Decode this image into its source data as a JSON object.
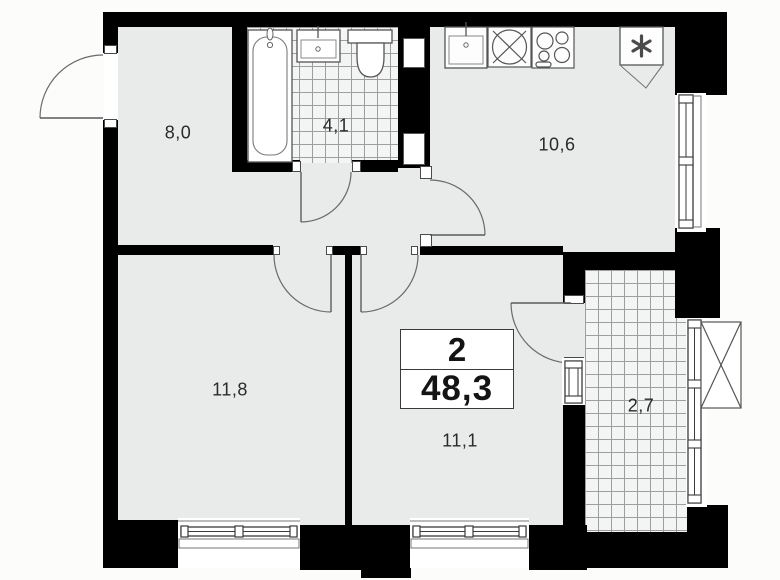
{
  "plan": {
    "title": "2-room apartment floor plan",
    "summary": {
      "rooms_count": "2",
      "total_area": "48,3"
    },
    "rooms": [
      {
        "name": "hallway",
        "area": "8,0"
      },
      {
        "name": "bathroom",
        "area": "4,1"
      },
      {
        "name": "kitchen",
        "area": "10,6"
      },
      {
        "name": "living-room",
        "area": "11,8"
      },
      {
        "name": "bedroom",
        "area": "11,1"
      },
      {
        "name": "balcony",
        "area": "2,7"
      }
    ],
    "icons": [
      "bathtub-icon",
      "bath-sink-icon",
      "toilet-icon",
      "kitchen-sink-icon",
      "washing-machine-icon",
      "stove-icon",
      "fridge-icon",
      "ac-unit-icon",
      "door-arc-icon",
      "window-icon"
    ],
    "colors": {
      "wall": "#000000",
      "floor": "#e9ebeb",
      "tile_floor": "#f3f4f4",
      "background": "#fcfcfb",
      "line": "#4a4a4a"
    }
  }
}
